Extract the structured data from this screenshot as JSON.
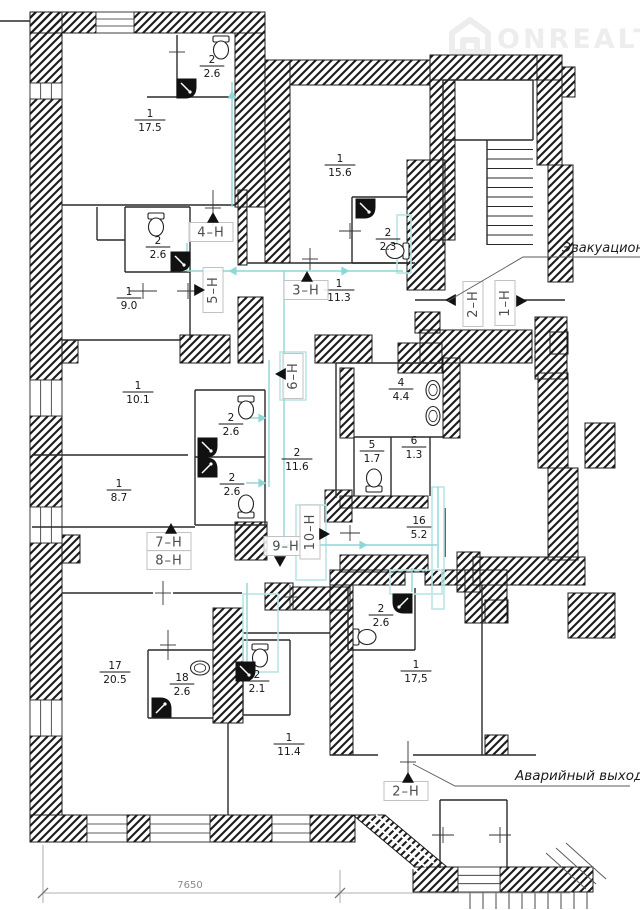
{
  "watermark": {
    "brand": "ONREALT"
  },
  "annotations": {
    "evacuation": "Эвакуацион",
    "emergency": "Аварийный выход",
    "dimension": "7650"
  },
  "colors": {
    "wall": "#1c1c1c",
    "thin": "#2a2a2a",
    "cyan": "#8fd6d6",
    "cyan_box": "#b9e6e6",
    "unit_box": "#c2c2c2",
    "unit_text": "#4d4d4d",
    "label_text": "#161616",
    "leader": "#5a5a5a",
    "dim": "#999999",
    "watermark": "#ededed"
  },
  "rooms": [
    {
      "n": "1",
      "a": "17.5",
      "x": 150,
      "y": 120
    },
    {
      "n": "2",
      "a": "2.6",
      "x": 212,
      "y": 66
    },
    {
      "n": "1",
      "a": "15.6",
      "x": 340,
      "y": 165
    },
    {
      "n": "2",
      "a": "2.3",
      "x": 388,
      "y": 239
    },
    {
      "n": "2",
      "a": "2.6",
      "x": 158,
      "y": 247
    },
    {
      "n": "1",
      "a": "9.0",
      "x": 129,
      "y": 298
    },
    {
      "n": "1",
      "a": "11.3",
      "x": 339,
      "y": 290
    },
    {
      "n": "1",
      "a": "10.1",
      "x": 138,
      "y": 392
    },
    {
      "n": "2",
      "a": "2.6",
      "x": 231,
      "y": 424
    },
    {
      "n": "2",
      "a": "2.6",
      "x": 232,
      "y": 484
    },
    {
      "n": "1",
      "a": "8.7",
      "x": 119,
      "y": 490
    },
    {
      "n": "2",
      "a": "11.6",
      "x": 297,
      "y": 459
    },
    {
      "n": "4",
      "a": "4.4",
      "x": 401,
      "y": 389
    },
    {
      "n": "5",
      "a": "1.7",
      "x": 372,
      "y": 451
    },
    {
      "n": "6",
      "a": "1.3",
      "x": 414,
      "y": 447
    },
    {
      "n": "16",
      "a": "5.2",
      "x": 419,
      "y": 527
    },
    {
      "n": "17",
      "a": "20.5",
      "x": 115,
      "y": 672
    },
    {
      "n": "18",
      "a": "2.6",
      "x": 182,
      "y": 684
    },
    {
      "n": "2",
      "a": "2.1",
      "x": 257,
      "y": 681
    },
    {
      "n": "1",
      "a": "11.4",
      "x": 289,
      "y": 744
    },
    {
      "n": "2",
      "a": "2.6",
      "x": 381,
      "y": 615
    },
    {
      "n": "1",
      "a": "17,5",
      "x": 416,
      "y": 671
    }
  ],
  "units": [
    {
      "t": "4–Н",
      "x": 211,
      "y": 232,
      "v": 0
    },
    {
      "t": "5–Н",
      "x": 213,
      "y": 290,
      "v": 1
    },
    {
      "t": "3–Н",
      "x": 306,
      "y": 290,
      "v": 0
    },
    {
      "t": "2–Н",
      "x": 473,
      "y": 304,
      "v": 1
    },
    {
      "t": "1–Н",
      "x": 505,
      "y": 303,
      "v": 1
    },
    {
      "t": "6–Н",
      "x": 293,
      "y": 376,
      "v": 1
    },
    {
      "t": "7–Н",
      "x": 169,
      "y": 542,
      "v": 0
    },
    {
      "t": "8–Н",
      "x": 169,
      "y": 560,
      "v": 0
    },
    {
      "t": "9–Н",
      "x": 286,
      "y": 546,
      "v": 0
    },
    {
      "t": "10–Н",
      "x": 310,
      "y": 532,
      "v": 1
    },
    {
      "t": "2–Н",
      "x": 406,
      "y": 791,
      "v": 0
    }
  ],
  "geometry": {
    "walls_rects": [
      [
        30,
        12,
        66,
        21
      ],
      [
        134,
        12,
        131,
        21
      ],
      [
        30,
        12,
        32,
        71
      ],
      [
        30,
        99,
        32,
        281
      ],
      [
        30,
        416,
        32,
        91
      ],
      [
        30,
        543,
        32,
        157
      ],
      [
        30,
        736,
        32,
        79
      ],
      [
        62,
        340,
        16,
        23
      ],
      [
        62,
        535,
        18,
        28
      ],
      [
        30,
        815,
        57,
        27
      ],
      [
        127,
        815,
        23,
        27
      ],
      [
        210,
        815,
        62,
        27
      ],
      [
        310,
        815,
        45,
        27
      ],
      [
        413,
        867,
        45,
        25
      ],
      [
        500,
        867,
        93,
        25
      ],
      [
        235,
        33,
        30,
        174
      ],
      [
        265,
        60,
        25,
        203
      ],
      [
        290,
        60,
        140,
        25
      ],
      [
        430,
        55,
        132,
        25
      ],
      [
        537,
        55,
        25,
        110
      ],
      [
        562,
        67,
        13,
        30
      ],
      [
        548,
        165,
        25,
        117
      ],
      [
        430,
        80,
        25,
        160
      ],
      [
        407,
        160,
        38,
        130
      ],
      [
        415,
        312,
        25,
        21
      ],
      [
        535,
        317,
        32,
        62
      ],
      [
        420,
        330,
        112,
        33
      ],
      [
        550,
        332,
        18,
        22
      ],
      [
        180,
        335,
        50,
        28
      ],
      [
        238,
        297,
        25,
        66
      ],
      [
        315,
        335,
        57,
        28
      ],
      [
        398,
        343,
        44,
        30
      ],
      [
        238,
        190,
        9,
        75
      ],
      [
        340,
        368,
        14,
        70
      ],
      [
        443,
        358,
        17,
        80
      ],
      [
        340,
        496,
        88,
        12
      ],
      [
        340,
        555,
        88,
        17
      ],
      [
        457,
        552,
        23,
        40
      ],
      [
        538,
        373,
        30,
        95
      ],
      [
        548,
        468,
        30,
        92
      ],
      [
        585,
        423,
        30,
        45
      ],
      [
        473,
        557,
        112,
        28
      ],
      [
        568,
        593,
        47,
        45
      ],
      [
        330,
        570,
        75,
        15
      ],
      [
        425,
        570,
        40,
        15
      ],
      [
        465,
        570,
        42,
        53
      ],
      [
        485,
        600,
        23,
        23
      ],
      [
        485,
        735,
        23,
        20
      ],
      [
        213,
        608,
        30,
        115
      ],
      [
        325,
        490,
        27,
        32
      ],
      [
        330,
        585,
        23,
        170
      ],
      [
        235,
        522,
        32,
        38
      ],
      [
        265,
        583,
        28,
        27
      ],
      [
        293,
        587,
        57,
        23
      ]
    ],
    "walls_polys": [
      [
        [
          353,
          815
        ],
        [
          385,
          815
        ],
        [
          447,
          867
        ],
        [
          415,
          867
        ]
      ]
    ],
    "ramp_lines": [
      [
        360,
        824,
        418,
        872
      ],
      [
        368,
        819,
        426,
        867
      ],
      [
        376,
        815,
        434,
        863
      ]
    ],
    "windows": [
      {
        "x": 96,
        "y": 12,
        "w": 38,
        "h": 21,
        "o": "h"
      },
      {
        "x": 30,
        "y": 83,
        "w": 32,
        "h": 16,
        "o": "v"
      },
      {
        "x": 30,
        "y": 380,
        "w": 32,
        "h": 36,
        "o": "v"
      },
      {
        "x": 30,
        "y": 507,
        "w": 32,
        "h": 36,
        "o": "v"
      },
      {
        "x": 30,
        "y": 700,
        "w": 32,
        "h": 36,
        "o": "v"
      },
      {
        "x": 87,
        "y": 815,
        "w": 40,
        "h": 27,
        "o": "h"
      },
      {
        "x": 150,
        "y": 815,
        "w": 60,
        "h": 27,
        "o": "h"
      },
      {
        "x": 272,
        "y": 815,
        "w": 38,
        "h": 27,
        "o": "h"
      },
      {
        "x": 458,
        "y": 867,
        "w": 42,
        "h": 25,
        "o": "h"
      }
    ],
    "thin_lines": [
      [
        62,
        205,
        235,
        205
      ],
      [
        177,
        35,
        177,
        98
      ],
      [
        147,
        97,
        235,
        97
      ],
      [
        97,
        207,
        97,
        240
      ],
      [
        97,
        240,
        125,
        240
      ],
      [
        125,
        207,
        125,
        272
      ],
      [
        125,
        207,
        190,
        207
      ],
      [
        190,
        207,
        190,
        272
      ],
      [
        125,
        272,
        190,
        272
      ],
      [
        190,
        272,
        190,
        340
      ],
      [
        62,
        340,
        180,
        340
      ],
      [
        32,
        455,
        188,
        455
      ],
      [
        195,
        390,
        195,
        525
      ],
      [
        195,
        390,
        265,
        390
      ],
      [
        265,
        390,
        265,
        525
      ],
      [
        195,
        525,
        265,
        525
      ],
      [
        195,
        457,
        265,
        457
      ],
      [
        336,
        363,
        443,
        363
      ],
      [
        336,
        363,
        336,
        498
      ],
      [
        354,
        437,
        443,
        437
      ],
      [
        391,
        437,
        391,
        496
      ],
      [
        430,
        437,
        430,
        496
      ],
      [
        354,
        437,
        354,
        496
      ],
      [
        445,
        508,
        445,
        557
      ],
      [
        352,
        197,
        407,
        197
      ],
      [
        352,
        197,
        352,
        263
      ],
      [
        352,
        263,
        413,
        263
      ],
      [
        247,
        263,
        415,
        263
      ],
      [
        62,
        593,
        153,
        593
      ],
      [
        173,
        593,
        242,
        593
      ],
      [
        243,
        633,
        330,
        633
      ],
      [
        228,
        723,
        228,
        815
      ],
      [
        148,
        650,
        213,
        650
      ],
      [
        148,
        650,
        148,
        718
      ],
      [
        148,
        718,
        213,
        718
      ],
      [
        243,
        640,
        290,
        640
      ],
      [
        290,
        640,
        290,
        715
      ],
      [
        243,
        715,
        290,
        715
      ],
      [
        243,
        640,
        243,
        715
      ],
      [
        348,
        588,
        348,
        650
      ],
      [
        348,
        650,
        415,
        650
      ],
      [
        415,
        588,
        415,
        650
      ],
      [
        482,
        585,
        482,
        755
      ],
      [
        330,
        755,
        378,
        755
      ],
      [
        413,
        755,
        536,
        755
      ],
      [
        440,
        800,
        507,
        800
      ],
      [
        440,
        800,
        440,
        868
      ],
      [
        507,
        800,
        507,
        868
      ],
      [
        443,
        80,
        533,
        80
      ],
      [
        533,
        80,
        533,
        140
      ],
      [
        443,
        140,
        533,
        140
      ],
      [
        487,
        140,
        487,
        245
      ],
      [
        443,
        80,
        443,
        245
      ],
      [
        0,
        21,
        30,
        21
      ],
      [
        415,
        300,
        452,
        300
      ],
      [
        517,
        300,
        565,
        300
      ],
      [
        32,
        527,
        195,
        527
      ]
    ],
    "stairs": {
      "x1": 487,
      "x2": 533,
      "y0": 140,
      "dy": 9.5,
      "n": 12,
      "out_x0": 470,
      "out_dx": 13,
      "out_n": 10,
      "out_y0": 892,
      "out_y1": 909,
      "fan": [
        [
          556,
          848,
          596,
          884
        ],
        [
          566,
          843,
          606,
          879
        ],
        [
          546,
          853,
          586,
          889
        ]
      ]
    },
    "cyan_lines": [
      [
        232,
        82,
        232,
        207
      ],
      [
        187,
        243,
        187,
        271
      ],
      [
        187,
        271,
        403,
        271
      ],
      [
        284,
        271,
        284,
        373
      ],
      [
        284,
        373,
        284,
        543
      ],
      [
        269,
        360,
        269,
        487
      ],
      [
        246,
        418,
        262,
        418
      ],
      [
        246,
        483,
        262,
        483
      ],
      [
        273,
        545,
        437,
        545
      ],
      [
        438,
        487,
        438,
        568
      ],
      [
        412,
        568,
        412,
        592
      ],
      [
        247,
        583,
        247,
        668
      ]
    ],
    "cyan_arrows": [
      {
        "x": 233,
        "y": 271,
        "d": "left"
      },
      {
        "x": 345,
        "y": 271,
        "d": "right"
      },
      {
        "x": 262,
        "y": 418,
        "d": "right"
      },
      {
        "x": 262,
        "y": 483,
        "d": "right"
      },
      {
        "x": 363,
        "y": 545,
        "d": "right"
      },
      {
        "x": 232,
        "y": 95,
        "d": "up"
      }
    ],
    "cyan_boxes": [
      [
        397,
        215,
        14,
        58
      ],
      [
        280,
        352,
        26,
        48
      ],
      [
        296,
        505,
        30,
        75
      ],
      [
        243,
        594,
        35,
        78
      ],
      [
        432,
        487,
        12,
        122
      ],
      [
        390,
        570,
        52,
        24
      ]
    ],
    "unit_arrows": [
      {
        "x": 213,
        "y": 218,
        "d": "up"
      },
      {
        "x": 199,
        "y": 290,
        "d": "right"
      },
      {
        "x": 307,
        "y": 277,
        "d": "up"
      },
      {
        "x": 451,
        "y": 300,
        "d": "left"
      },
      {
        "x": 521,
        "y": 301,
        "d": "right"
      },
      {
        "x": 281,
        "y": 374,
        "d": "left"
      },
      {
        "x": 171,
        "y": 529,
        "d": "up"
      },
      {
        "x": 280,
        "y": 561,
        "d": "down"
      },
      {
        "x": 324,
        "y": 534,
        "d": "right"
      },
      {
        "x": 408,
        "y": 778,
        "d": "up"
      }
    ],
    "toilets": [
      {
        "x": 221,
        "y": 49,
        "dir": "top"
      },
      {
        "x": 156,
        "y": 226,
        "dir": "top"
      },
      {
        "x": 396,
        "y": 251,
        "dir": "right"
      },
      {
        "x": 246,
        "y": 409,
        "dir": "top"
      },
      {
        "x": 246,
        "y": 505,
        "dir": "bottom"
      },
      {
        "x": 374,
        "y": 479,
        "dir": "bottom"
      },
      {
        "x": 260,
        "y": 657,
        "dir": "top"
      },
      {
        "x": 366,
        "y": 637,
        "dir": "left"
      }
    ],
    "sinks": [
      {
        "x": 433,
        "y": 390,
        "horiz": false
      },
      {
        "x": 433,
        "y": 416,
        "horiz": false
      },
      {
        "x": 200,
        "y": 668,
        "horiz": true
      }
    ],
    "showers": [
      {
        "x": 177,
        "y": 79,
        "c": "br"
      },
      {
        "x": 356,
        "y": 199,
        "c": "br"
      },
      {
        "x": 171,
        "y": 252,
        "c": "br"
      },
      {
        "x": 198,
        "y": 438,
        "c": "br"
      },
      {
        "x": 198,
        "y": 458,
        "c": "tr"
      },
      {
        "x": 152,
        "y": 698,
        "c": "tr"
      },
      {
        "x": 236,
        "y": 662,
        "c": "br"
      },
      {
        "x": 393,
        "y": 594,
        "c": "bl"
      }
    ],
    "crosses": [
      {
        "x": 213,
        "y": 208,
        "len": 36,
        "o": "v"
      },
      {
        "x": 143,
        "y": 291,
        "len": 28,
        "o": "h"
      },
      {
        "x": 188,
        "y": 291,
        "len": 22,
        "o": "h"
      },
      {
        "x": 310,
        "y": 259,
        "len": 22,
        "o": "v"
      },
      {
        "x": 177,
        "y": 52,
        "len": 24,
        "o": "v"
      },
      {
        "x": 350,
        "y": 231,
        "len": 22,
        "o": "h"
      },
      {
        "x": 168,
        "y": 645,
        "len": 30,
        "o": "v"
      },
      {
        "x": 408,
        "y": 762,
        "len": 42,
        "o": "v"
      },
      {
        "x": 443,
        "y": 835,
        "len": 22,
        "o": "h"
      },
      {
        "x": 500,
        "y": 835,
        "len": 22,
        "o": "h"
      },
      {
        "x": 163,
        "y": 593,
        "len": 24,
        "o": "v"
      },
      {
        "x": 290,
        "y": 597,
        "len": 24,
        "o": "v"
      },
      {
        "x": 350,
        "y": 533,
        "len": 20,
        "o": "h"
      }
    ],
    "leaders": [
      [
        [
          448,
          301
        ],
        [
          523,
          257
        ],
        [
          640,
          257
        ]
      ],
      [
        [
          413,
          764
        ],
        [
          455,
          786
        ],
        [
          630,
          786
        ]
      ]
    ],
    "dim": {
      "line": [
        43,
        893,
        570,
        893
      ],
      "ext": [
        [
          43,
          845,
          43,
          903
        ],
        [
          340,
          870,
          340,
          903
        ]
      ],
      "ticks": [
        [
          43,
          893
        ],
        [
          340,
          893
        ]
      ]
    }
  }
}
